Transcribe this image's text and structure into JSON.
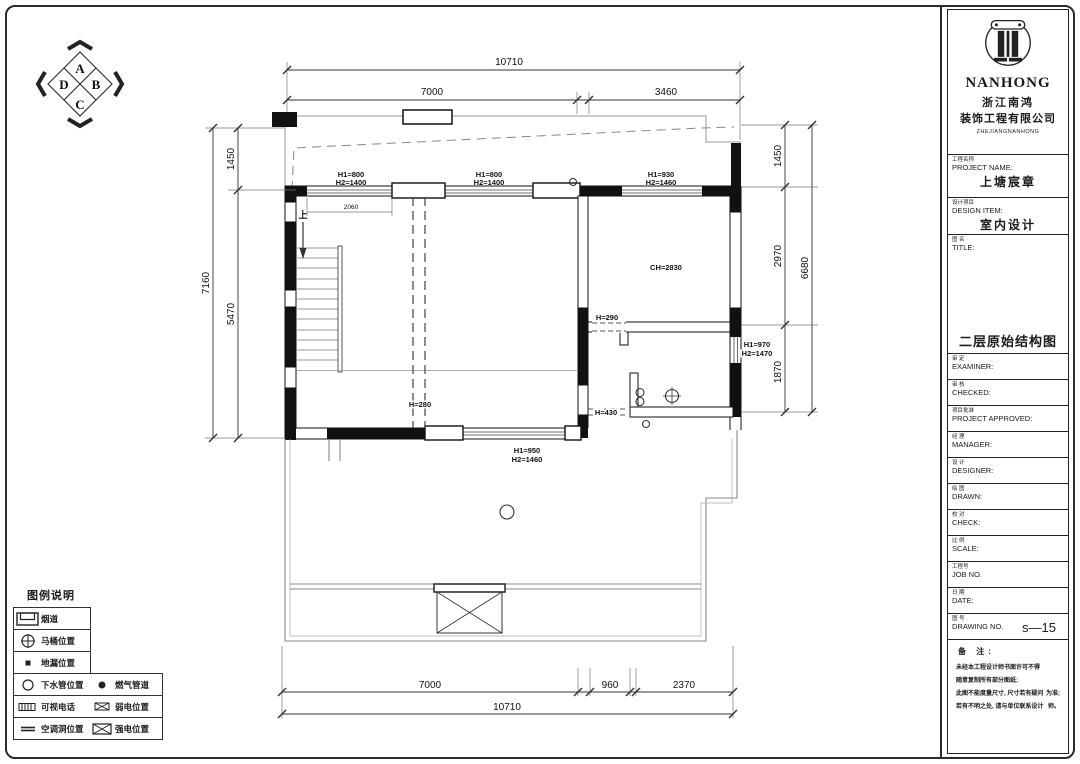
{
  "compass": {
    "top": "A",
    "right": "B",
    "bottom": "C",
    "left": "D"
  },
  "logo": {
    "name": "NANHONG",
    "company_cn_1": "浙江南鸿",
    "company_cn_2": "装饰工程有限公司",
    "company_en": "ZHEJIANGNANHONG"
  },
  "title_block": {
    "project": {
      "cn": "工程名称",
      "en": "PROJECT NAME:",
      "value": "上塘宸章"
    },
    "design": {
      "cn": "设计项目",
      "en": "DESIGN ITEM:",
      "value": "室内设计"
    },
    "title": {
      "cn": "图 名",
      "en": "TITLE:",
      "value": "二层原始结构图"
    },
    "rows": [
      {
        "cn": "审 定",
        "en": "EXAMINER:"
      },
      {
        "cn": "审 核",
        "en": "CHECKED:"
      },
      {
        "cn": "项目批准",
        "en": "PROJECT  APPROVED:"
      },
      {
        "cn": "经 理",
        "en": "MANAGER:"
      },
      {
        "cn": "设 计",
        "en": "DESIGNER:"
      },
      {
        "cn": "绘 图",
        "en": "DRAWN:"
      },
      {
        "cn": "校 对",
        "en": "CHECK:"
      },
      {
        "cn": "比 例",
        "en": "SCALE:"
      },
      {
        "cn": "工程号",
        "en": "JOB  NO."
      },
      {
        "cn": "日 期",
        "en": "DATE:"
      },
      {
        "cn": "图 号",
        "en": "DRAWING NO."
      }
    ],
    "drawing_no": "s—15",
    "notes": {
      "cn": "备  注:",
      "lines": [
        "未经本工程设计师书面许可不得",
        "随意复制所有部分图纸;",
        "此图不能度量尺寸, 尺寸若有疑问",
        "为准;",
        "若有不明之处, 请与单位联系设计",
        "师。"
      ]
    }
  },
  "legend": {
    "title": "图例说明",
    "rows": [
      {
        "label": "烟道"
      },
      {
        "label": "马桶位置"
      },
      {
        "label": "地漏位置"
      },
      {
        "label": "下水管位置",
        "label2": "燃气管道"
      },
      {
        "label": "可视电话",
        "label2": "弱电位置"
      },
      {
        "label": "空调洞位置",
        "label2": "强电位置"
      }
    ]
  },
  "plan": {
    "dims": {
      "top_overall": "10710",
      "top_left": "7000",
      "top_right": "3460",
      "left_outer": "7160",
      "left_top": "1450",
      "left_bottom": "5470",
      "right_outer": "6680",
      "right_top": "1450",
      "right_mid": "2970",
      "right_low": "1870",
      "bottom_1": "7000",
      "bottom_2": "960",
      "bottom_3": "2370",
      "bottom_overall": "10710",
      "window_width": "2060"
    },
    "labels": {
      "win_tl_a": "H1=800",
      "win_tl_b": "H2=1400",
      "win_tm_a": "H1=800",
      "win_tm_b": "H2=1400",
      "win_tr_a": "H1=930",
      "win_tr_b": "H2=1460",
      "win_r_a": "H1=970",
      "win_r_b": "H2=1470",
      "win_b_a": "H1=950",
      "win_b_b": "H2=1460",
      "ceiling": "CH=2830",
      "opening_h290": "H=290",
      "opening_h430": "H=430",
      "beam_h280": "H=280",
      "stair_up": "上"
    }
  }
}
